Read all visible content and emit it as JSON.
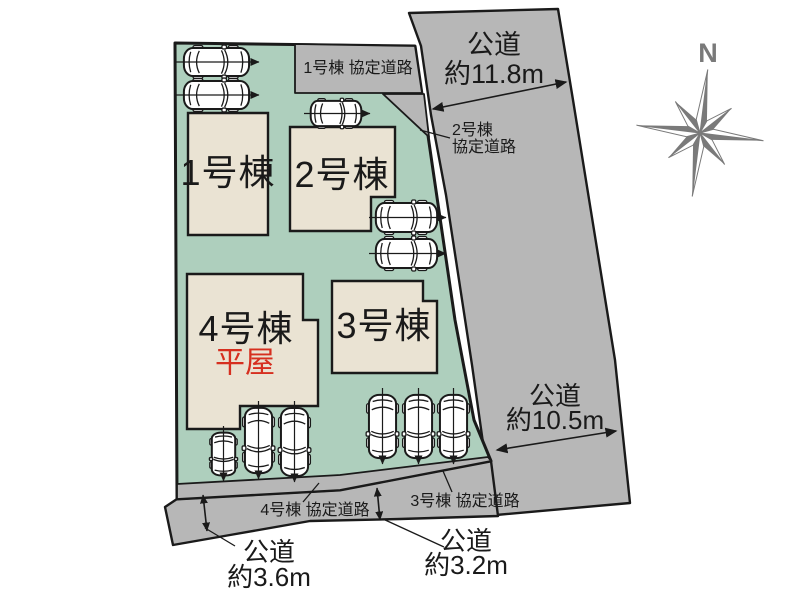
{
  "buildings": {
    "b1": {
      "label": "1号棟"
    },
    "b2": {
      "label": "2号棟"
    },
    "b3": {
      "label": "3号棟"
    },
    "b4": {
      "label": "4号棟",
      "note": "平屋"
    }
  },
  "kyotei_roads": {
    "b1": "1号棟 協定道路",
    "b2_line1": "2号棟",
    "b2_line2": "協定道路",
    "b3": "3号棟 協定道路",
    "b4": "4号棟 協定道路"
  },
  "public_roads": {
    "right_top": {
      "name": "公道",
      "size": "約11.8m"
    },
    "right_bottom": {
      "name": "公道",
      "size": "約10.5m"
    },
    "bottom_left": {
      "name": "公道",
      "size": "約3.6m"
    },
    "bottom_mid": {
      "name": "公道",
      "size": "約3.2m"
    }
  },
  "compass": {
    "north": "N"
  },
  "colors": {
    "plot_green": "#aecfbd",
    "building_beige": "#eae3d3",
    "road_gray": "#b7b7b7",
    "ink": "#1a1a1a",
    "hiraya_red": "#d62f1f",
    "compass_gray": "#7a7a7a"
  }
}
